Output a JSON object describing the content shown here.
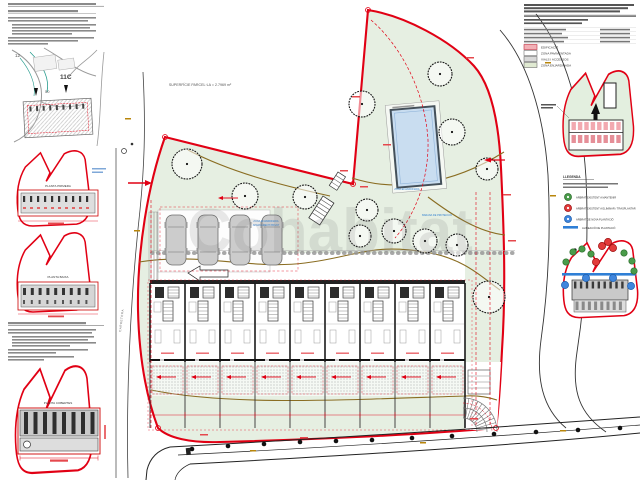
{
  "colors": {
    "boundary_red": "#e10014",
    "parcel_green": "#e6efe2",
    "pool_blue": "#c9ddf0",
    "contour_brown": "#8a6d22",
    "annotation_blue": "#2f7fd0"
  },
  "left_column": {
    "inset_map": {
      "labels": {
        "block": "12",
        "parcel": "11C",
        "plot": "50"
      }
    },
    "floor_diagrams": [
      {
        "label": "PLANTA PRIMERA"
      },
      {
        "label": "PLANTA BAIXA"
      },
      {
        "label": "PLANTA COBERTES"
      }
    ]
  },
  "main_plan": {
    "area_label": "SUPERFÍCIE PARCEL·LA = 2.7969 m²",
    "street_label_vertical": "CARRETERA",
    "blue_annotations": [
      "ZONA ENJARDINADA",
      "APARCAMENT PRIVAT",
      "BARANA DE PROTECCIÓ"
    ]
  },
  "title_block": {
    "legend": [
      {
        "label": "EDIFICACIÓ",
        "color": "#f2b0b6"
      },
      {
        "label": "ZONA PAVIMENTADA",
        "color": "#ffffff"
      },
      {
        "label": "VIALS I ACCESSOS",
        "color": "#d9d9d9"
      },
      {
        "label": "ZONA ENJARDINADA",
        "color": "#e0ead2"
      }
    ]
  },
  "tree_legend": {
    "heading": "LLEGENDA",
    "items": [
      {
        "symbol": "green-circle",
        "label": "ARBRAT EXISTENT A MANTENIR"
      },
      {
        "symbol": "red-circle",
        "label": "ARBRAT EXISTENT A ELIMINAR / TRASPLANTAR"
      },
      {
        "symbol": "blue-circle",
        "label": "ARBRAT DE NOVA PLANTACIÓ"
      },
      {
        "symbol": "blue-line",
        "label": "ALINEACIÓ DE PLANTACIÓ"
      }
    ]
  },
  "watermark": "Cohabitat"
}
